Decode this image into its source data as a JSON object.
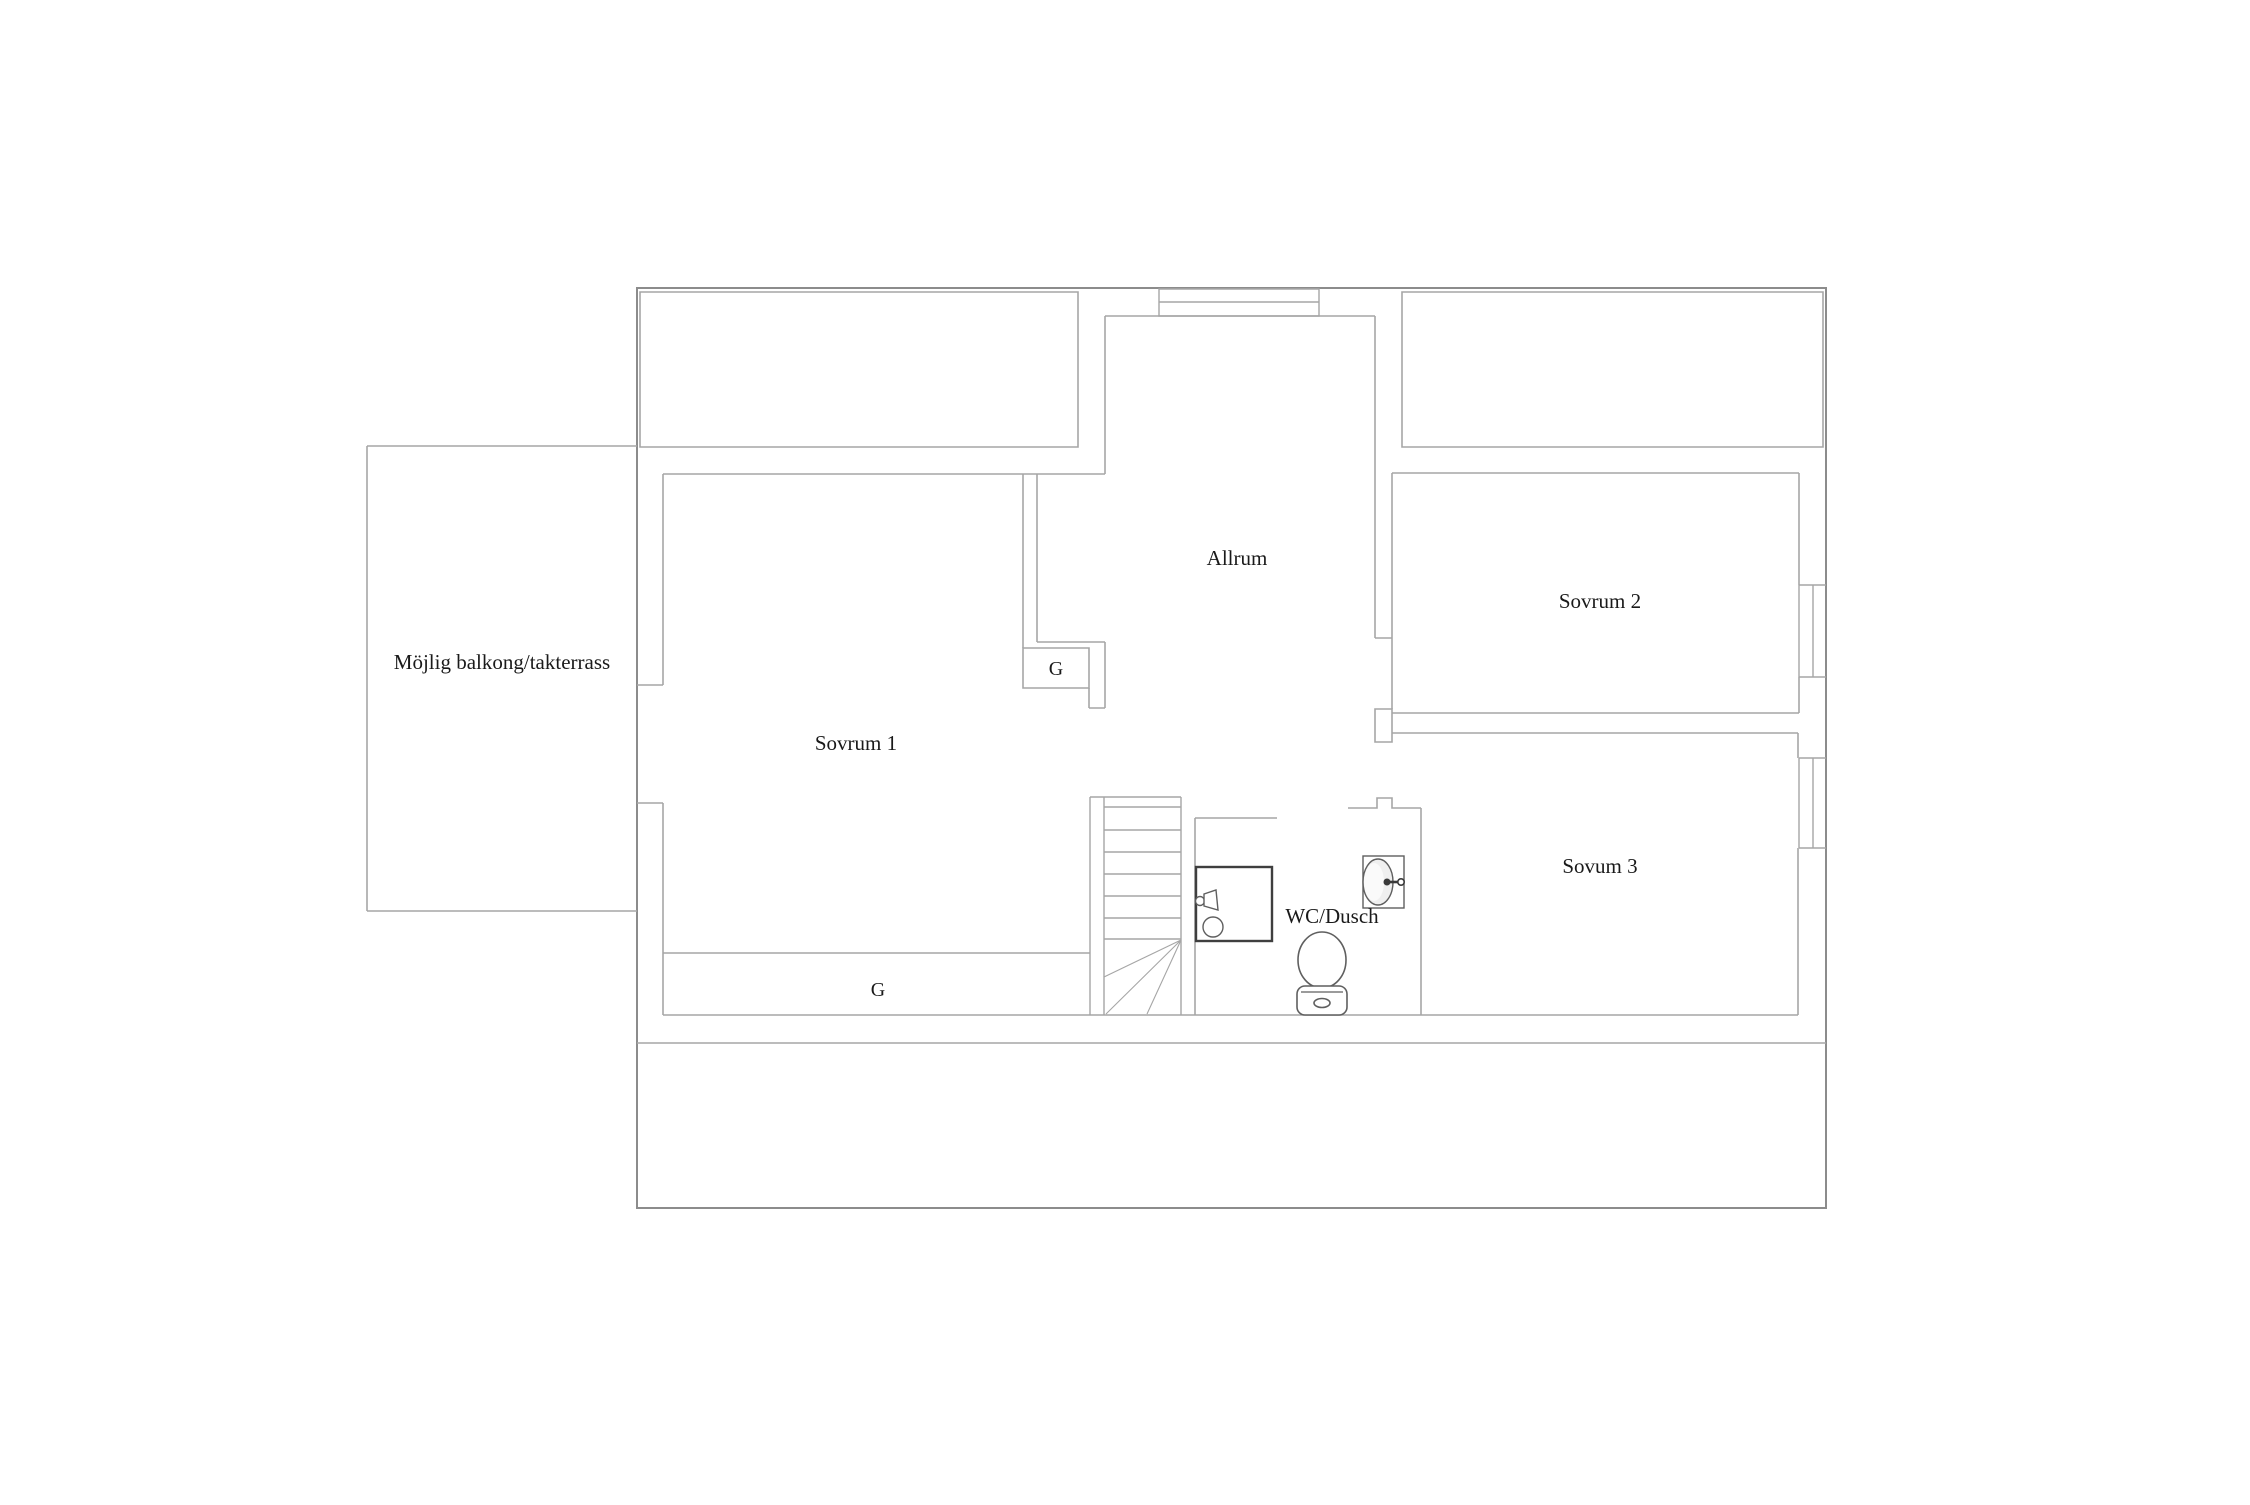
{
  "document": {
    "type": "floor-plan",
    "background": "#ffffff"
  },
  "colors": {
    "outer_wall": "#8c8c8c",
    "wall": "#a6a6a6",
    "fixture": "#5f5f5f",
    "shower_border": "#3f3f3f",
    "tap": "#3a3a3a",
    "basin_fill": "#efefef",
    "text": "#1a1a1a"
  },
  "rooms": {
    "balcony": {
      "label": "Möjlig balkong/takterrass"
    },
    "sovrum1": {
      "label": "Sovrum 1"
    },
    "allrum": {
      "label": "Allrum"
    },
    "sovrum2": {
      "label": "Sovrum 2"
    },
    "sovum3": {
      "label": "Sovum 3"
    },
    "wc_dusch": {
      "label": "WC/Dusch"
    },
    "closet_upper": {
      "label": "G"
    },
    "closet_lower": {
      "label": "G"
    }
  },
  "fixtures": {
    "stairs": "winder-staircase",
    "shower": "shower-square",
    "toilet": "toilet",
    "sink": "wall-sink",
    "windows": [
      "top-wall-window",
      "right-wall-window-upper",
      "right-wall-window-lower"
    ]
  }
}
